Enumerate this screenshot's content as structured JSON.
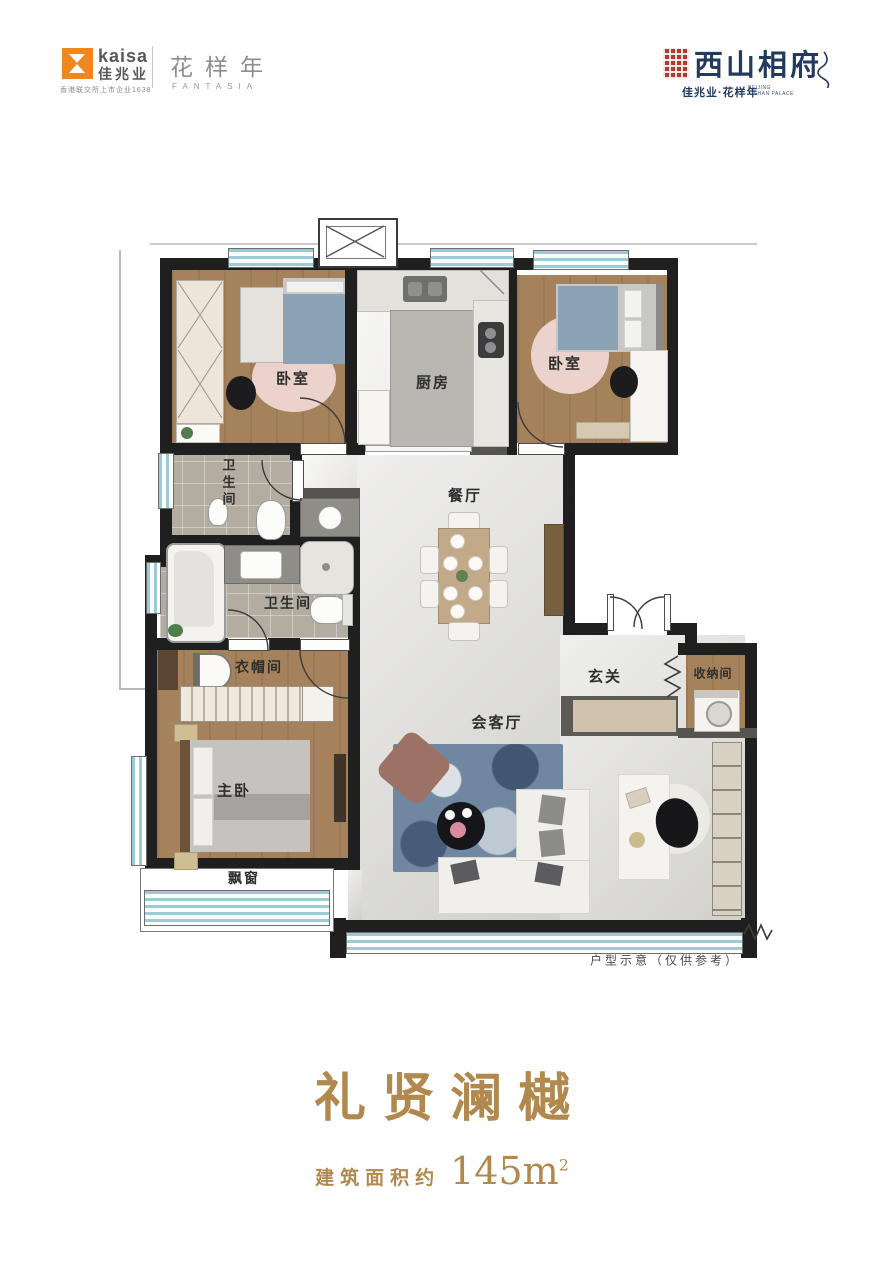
{
  "header": {
    "kaisa": {
      "brand_en": "kaisa",
      "brand_cn": "佳兆业",
      "tagline": "香港联交所上市企业1638"
    },
    "fantasia": {
      "cn": "花样年",
      "en": "FANTASIA"
    },
    "project": {
      "title": "西山相府",
      "subtitle_cn": "佳兆业·花样年",
      "subtitle_en_line1": "BEIJING",
      "subtitle_en_line2": "XISHAN PALACE"
    }
  },
  "floorplan": {
    "rooms": {
      "bedroom1": "卧室",
      "kitchen": "厨房",
      "bedroom2": "卧室",
      "bath1": "卫生间",
      "bath2": "卫生间",
      "dining": "餐厅",
      "cloakroom": "衣帽间",
      "master": "主卧",
      "bay": "飘窗",
      "living": "会客厅",
      "foyer": "玄关",
      "storage": "收纳间"
    },
    "note": "户型示意（仅供参考）"
  },
  "footer": {
    "title": "礼贤澜樾",
    "area_prefix": "建筑面积约",
    "area_number": "145m",
    "area_sup": "2"
  },
  "colors": {
    "accent_gold": "#b1894e",
    "brand_orange": "#f0871a",
    "seal_red": "#b23a31",
    "brand_navy": "#223a5e",
    "wall_black": "#1f1f1f",
    "window_blue": "#9ccbd8",
    "wood": "#a5825c",
    "marble": "#dcdbd7",
    "rug_blue": "#6f87a0",
    "rug_pink": "#ecd2cc",
    "bed_blue": "#8ba3b4"
  }
}
